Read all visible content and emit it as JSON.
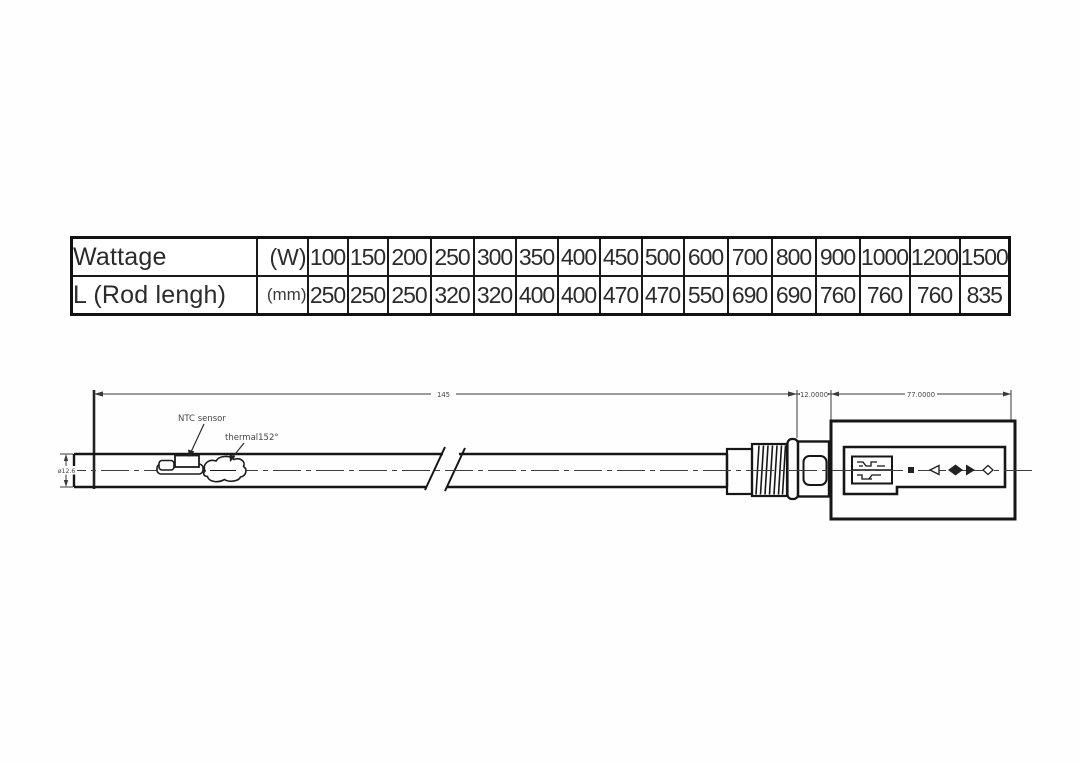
{
  "table": {
    "rows": [
      {
        "label": "Wattage",
        "unit": "(W)",
        "values": [
          "100",
          "150",
          "200",
          "250",
          "300",
          "350",
          "400",
          "450",
          "500",
          "600",
          "700",
          "800",
          "900",
          "1000",
          "1200",
          "1500"
        ]
      },
      {
        "label": "L (Rod lengh)",
        "unit": "(mm)",
        "values": [
          "250",
          "250",
          "250",
          "320",
          "320",
          "400",
          "400",
          "470",
          "470",
          "550",
          "690",
          "690",
          "760",
          "760",
          "760",
          "835"
        ]
      }
    ]
  },
  "drawing": {
    "ntc_label": "NTC sensor",
    "thermal_label": "thermal152°",
    "dim_total": "145",
    "dim_thread": "12.0000",
    "dim_housing": "77.0000",
    "dim_diameter": "ø12.6"
  },
  "colors": {
    "line": "#1c1c1c",
    "dim_line": "#3a3a3a",
    "text": "#2b2b2b"
  }
}
